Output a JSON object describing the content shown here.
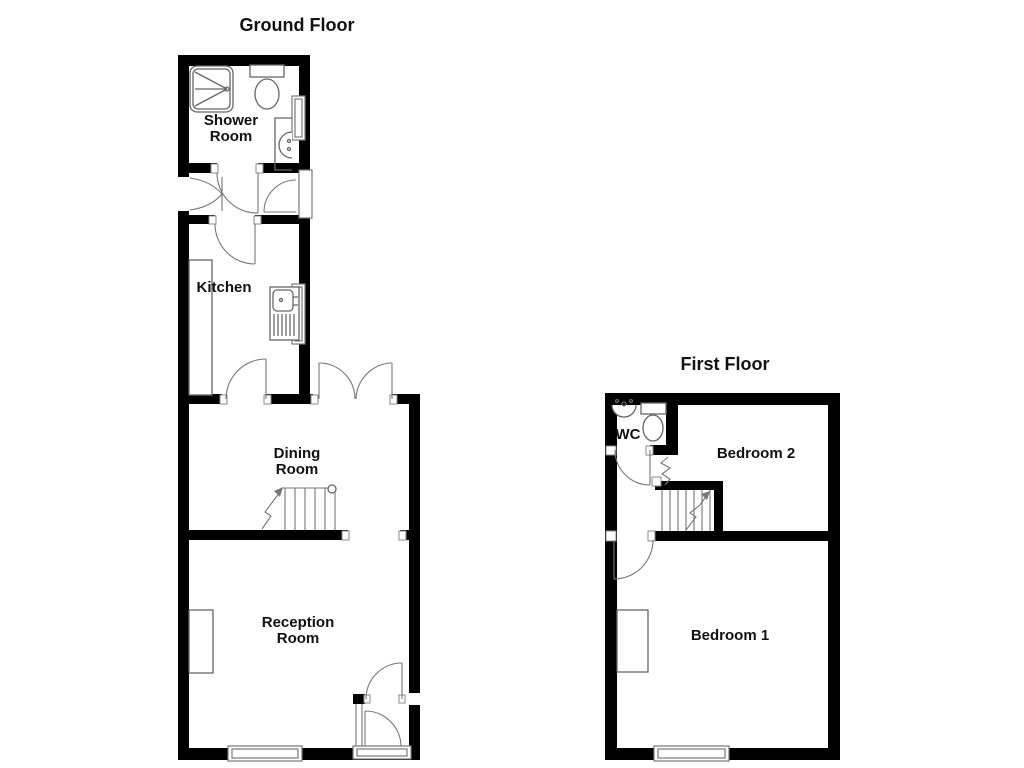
{
  "ground_floor": {
    "title": "Ground Floor",
    "rooms": [
      {
        "name": "Shower Room",
        "label_line1": "Shower",
        "label_line2": "Room"
      },
      {
        "name": "Kitchen",
        "label_line1": "Kitchen"
      },
      {
        "name": "Dining Room",
        "label_line1": "Dining",
        "label_line2": "Room"
      },
      {
        "name": "Reception Room",
        "label_line1": "Reception",
        "label_line2": "Room"
      }
    ],
    "fixtures": [
      "shower-cubicle",
      "toilet",
      "basin",
      "kitchen-sink-drainer",
      "kitchen-worktop",
      "staircase",
      "french-doors",
      "entrance-porch",
      "windows"
    ]
  },
  "first_floor": {
    "title": "First Floor",
    "rooms": [
      {
        "name": "WC",
        "label_line1": "WC"
      },
      {
        "name": "Bedroom 2",
        "label_line1": "Bedroom 2"
      },
      {
        "name": "Bedroom 1",
        "label_line1": "Bedroom 1"
      }
    ],
    "fixtures": [
      "basin",
      "toilet",
      "staircase",
      "window",
      "chimney-breast"
    ]
  },
  "colors": {
    "wall": "#000000",
    "detail_line": "#666666",
    "text": "#111111",
    "background": "#ffffff"
  }
}
